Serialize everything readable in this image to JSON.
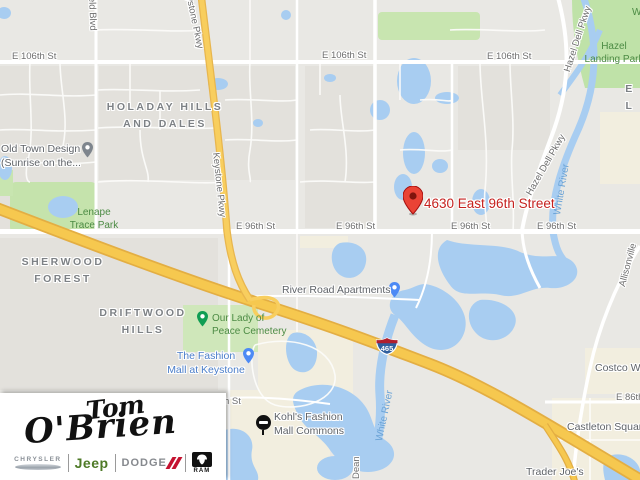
{
  "map": {
    "marker": {
      "label": "4630 East 96th Street"
    },
    "highway_shield": "465",
    "streets": {
      "e106_1": "E 106th St",
      "e106_2": "E 106th St",
      "e106_3": "E 106th St",
      "e96_1": "E 96th St",
      "e96_2": "E 96th St",
      "e96_3": "E 96th St",
      "e96_4": "E 96th St",
      "e86": "E 86th St",
      "h_st": "h St",
      "keystone_1": "Keystone Pkwy",
      "keystone_2": "Keystone Pkwy",
      "hazel_dell_1": "Hazel Dell Pkwy",
      "hazel_dell_2": "Hazel Dell Pkwy",
      "field_blvd": "field Blvd",
      "allisonville": "Allisonville",
      "dean": "Dean"
    },
    "water_labels": {
      "white_river_1": "White River",
      "white_river_2": "White River"
    },
    "neighborhoods": {
      "holaday": [
        "HOLADAY HILLS",
        "AND DALES"
      ],
      "sherwood": [
        "SHERWOOD",
        "FOREST"
      ],
      "driftwood": [
        "DRIFTWOOD",
        "HILLS"
      ],
      "el": "E L"
    },
    "parks": {
      "lenape": [
        "Lenape",
        "Trace Park"
      ],
      "hazel_landing": [
        "Hazel",
        "Landing Park"
      ],
      "our_lady": [
        "Our Lady of",
        "Peace Cemetery"
      ],
      "w_partial": "W"
    },
    "pois": {
      "old_town": [
        "Old Town Design",
        "(Sunrise on the..."
      ],
      "river_road": "River Road Apartments",
      "fashion_mall": [
        "The Fashion",
        "Mall at Keystone"
      ],
      "kohls": [
        "Kohl's Fashion",
        "Mall Commons"
      ],
      "castleton": "Castleton Square",
      "trader_joes": "Trader Joe's",
      "costco": "Costco Wholesale"
    }
  },
  "logo": {
    "name_top": "Tom",
    "name_bottom": "O'Brien",
    "brand_chrysler": "CHRYSLER",
    "brand_jeep": "Jeep",
    "brand_dodge": "DODGE",
    "brand_ram": "RAM"
  },
  "colors": {
    "marker_red": "#ea4335",
    "address_text": "#c5221f",
    "water": "#a8cdf1",
    "park_green": "#c5e3ac",
    "road_yellow": "#f8ce5e",
    "highway_yellow": "#f6c84f",
    "poi_blue": "#4d8af5",
    "poi_green": "#109e53",
    "jeep_green": "#4e7a27",
    "dodge_red": "#c41230",
    "kohls_black": "#111111"
  }
}
